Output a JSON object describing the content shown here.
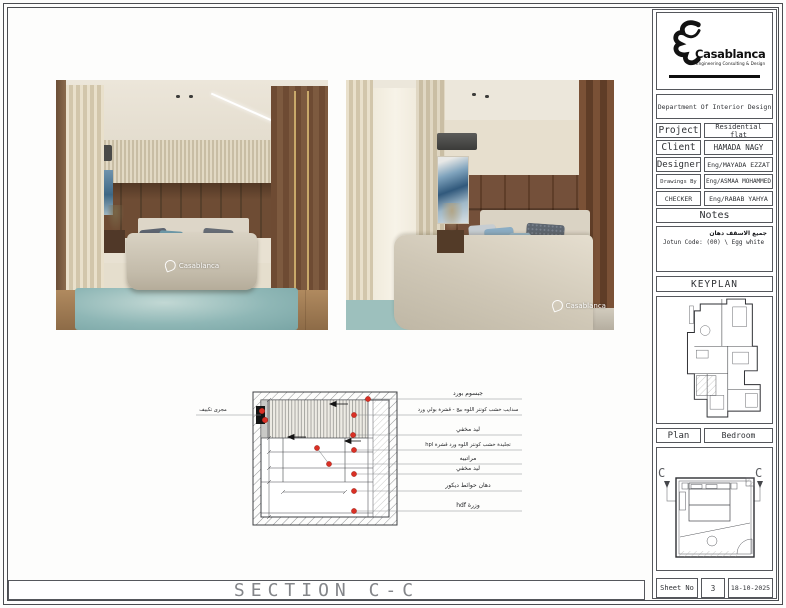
{
  "sheet": {
    "section_title": "SECTION C-C"
  },
  "brand": {
    "name": "Casablanca",
    "tagline": "Engineering Consulting & Design",
    "watermark": "Casablanca"
  },
  "title_block": {
    "department": "Department Of Interior Design",
    "rows": [
      {
        "label": "Project",
        "value": "Residential flat"
      },
      {
        "label": "Client",
        "value": "HAMADA NAGY"
      },
      {
        "label": "Designer",
        "value": "Eng/MAYADA EZZAT"
      },
      {
        "label": "Drawings By",
        "value": "Eng/ASMAA MOHAMMED"
      },
      {
        "label": "CHECKER",
        "value": "Eng/RABAB YAHYA"
      }
    ],
    "notes_title": "Notes",
    "notes_ar": "جميع الاسقف دهان",
    "notes_en": "Jotun Code: (00) \\ Egg white",
    "keyplan_title": "KEYPLAN",
    "plan_label": "Plan",
    "plan_value": "Bedroom",
    "marker_left": "C",
    "marker_right": "C",
    "sheet_label": "Sheet No",
    "sheet_number": "3",
    "sheet_date": "18-10-2025"
  },
  "section_drawing": {
    "left_label": "مجرى تكييف",
    "labels": [
      "جبسوم بورد",
      "سدايب خشب كونتر اللوه بيج - قشرة بولي ورد",
      "ليد مخفي",
      "تجليدة خشب كونتر اللوه ورد قشرة hpl",
      "مراتبيه",
      "ليد مخفي",
      "دهان حوائط ديكور",
      "وزرة hdf"
    ]
  },
  "colors": {
    "marker_red": "#d93025",
    "line_dark": "#3f4145",
    "wood": "#6e4c34",
    "curtain": "#ddd2bb",
    "rug_teal": "#8fb7b6"
  }
}
